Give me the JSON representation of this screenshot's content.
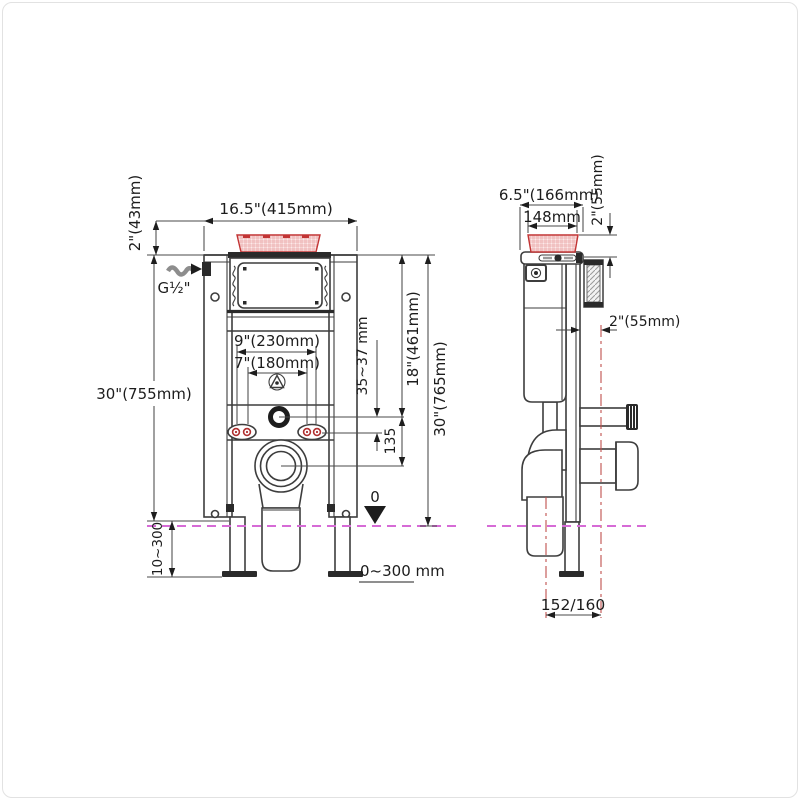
{
  "figure": {
    "type": "installation dimension drawing",
    "subject": "concealed in-wall cistern carrier frame — front view and side view"
  },
  "colors": {
    "line": "#3d3d3d",
    "flush_plate_red": "#c23434",
    "floor_line_magenta": "#d66bd6",
    "center_line_red": "#c0504d"
  },
  "front_view": {
    "labels": {
      "width_top": "16.5\"(415mm)",
      "plate_height": "2\"(43mm)",
      "water_inlet": "G½\"",
      "height_overall_left": "30\"(755mm)",
      "bolt_spacing_outer": "9\"(230mm)",
      "bolt_spacing_inner": "7\"(180mm)",
      "supply_range": "35~37 mm",
      "height_to_supply": "18\"(461mm)",
      "height_overall_right": "30\"(765mm)",
      "drop_135": "135",
      "foot_range": "10~300",
      "datum_zero": "0",
      "floor_range": "0~300 mm"
    }
  },
  "side_view": {
    "labels": {
      "depth_top": "6.5\"(166mm)",
      "plate_width": "148mm",
      "plate_depth": "2\"(55mm)",
      "wall_offset": "2\"(55mm)",
      "outlet_offset": "152/160"
    }
  }
}
